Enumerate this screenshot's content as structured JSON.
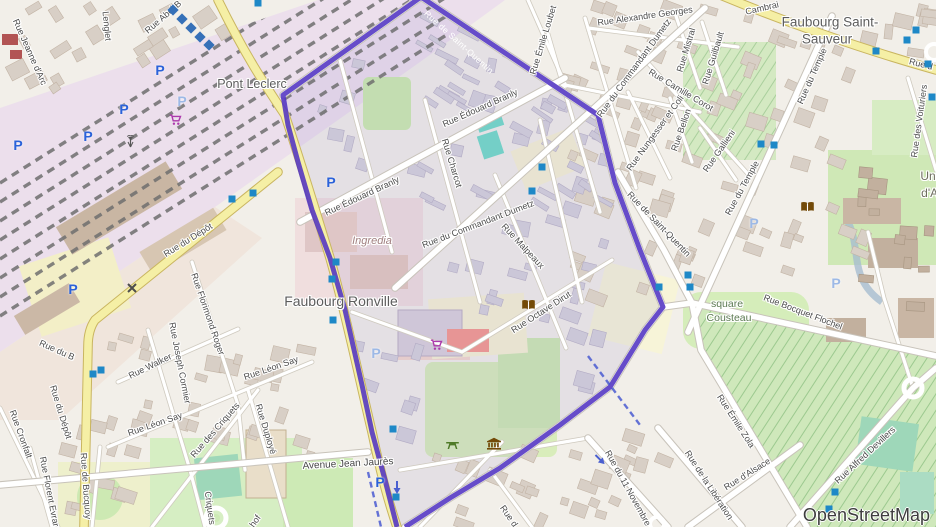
{
  "attribution": {
    "text": "OpenStreetMap"
  },
  "colors": {
    "boundary_purple": "#5133c2",
    "road_yellow": "#f5efa5",
    "base": "#f2efe9",
    "building_gray": "#d8cfc6",
    "building_inner": "#cbc7d8",
    "park_green": "#cdebb0",
    "pitch_teal": "#9ed7b9",
    "marker_blue": "#1e88c7",
    "parking_blue": "#2b62d9",
    "rail_area": "#ecdfec"
  },
  "place_labels": [
    {
      "text": "Pont Leclerc",
      "x": 252,
      "y": 84,
      "cls": "town",
      "size": 12.5
    },
    {
      "text": "Faubourg Saint-",
      "x": 830,
      "y": 22,
      "cls": "town",
      "size": 13.5
    },
    {
      "text": "Sauveur",
      "x": 827,
      "y": 39,
      "cls": "town",
      "size": 13.5
    },
    {
      "text": "Faubourg  Ronville",
      "x": 341,
      "y": 301,
      "cls": "town",
      "size": 14
    },
    {
      "text": "Ingredia",
      "x": 372,
      "y": 241,
      "cls": "ind",
      "size": 11
    },
    {
      "text": "square",
      "x": 727,
      "y": 304,
      "cls": "park",
      "size": 10.5
    },
    {
      "text": "Cousteau",
      "x": 729,
      "y": 318,
      "cls": "park",
      "size": 10.5
    },
    {
      "text": "Université",
      "x": 947,
      "y": 176,
      "cls": "univ",
      "size": 12
    },
    {
      "text": "d'Artois",
      "x": 941,
      "y": 193,
      "cls": "univ",
      "size": 12
    }
  ],
  "street_labels": [
    {
      "text": "Rue Jeanne d'Arc",
      "x": 30,
      "y": 52,
      "rot": 66
    },
    {
      "text": "Lenglet",
      "x": 107,
      "y": 26,
      "rot": 84
    },
    {
      "text": "Rue Abel B",
      "x": 163,
      "y": 17,
      "rot": -41
    },
    {
      "text": "Rue Alexandre Georges",
      "x": 645,
      "y": 16,
      "rot": -8
    },
    {
      "text": "Cambrai",
      "x": 762,
      "y": 8,
      "rot": -13
    },
    {
      "text": "Rue d",
      "x": 921,
      "y": 64,
      "rot": 14
    },
    {
      "text": "Rue Émile Loubet",
      "x": 543,
      "y": 40,
      "rot": -73
    },
    {
      "text": "Rue Mistral",
      "x": 686,
      "y": 50,
      "rot": -73
    },
    {
      "text": "Rue Guilbault",
      "x": 713,
      "y": 58,
      "rot": -73
    },
    {
      "text": "Rue du Commandant Dumetz",
      "x": 634,
      "y": 68,
      "rot": -54
    },
    {
      "text": "Rue Camille Corot",
      "x": 681,
      "y": 90,
      "rot": 31
    },
    {
      "text": "Rue du Temple",
      "x": 812,
      "y": 76,
      "rot": -66
    },
    {
      "text": "Rue Bellon",
      "x": 681,
      "y": 130,
      "rot": -71
    },
    {
      "text": "Rue Nungesser et Coli",
      "x": 655,
      "y": 133,
      "rot": -54
    },
    {
      "text": "Rue Gallieni",
      "x": 719,
      "y": 151,
      "rot": -55
    },
    {
      "text": "Rue des Voituriers",
      "x": 919,
      "y": 121,
      "rot": -82
    },
    {
      "text": "Rue du Temple",
      "x": 742,
      "y": 188,
      "rot": -61
    },
    {
      "text": "Rue de Saint-Quentin",
      "x": 459,
      "y": 42,
      "rot": 42,
      "cls": "stw"
    },
    {
      "text": "Rue de Saint-Quentin",
      "x": 659,
      "y": 224,
      "rot": 46
    },
    {
      "text": "Rue Édouard Branly",
      "x": 480,
      "y": 108,
      "rot": -24
    },
    {
      "text": "Rue Charcot",
      "x": 452,
      "y": 163,
      "rot": 73
    },
    {
      "text": "Rue Édouard Branly",
      "x": 362,
      "y": 196,
      "rot": -25
    },
    {
      "text": "Rue du Commandant Dumetz",
      "x": 478,
      "y": 224,
      "rot": -21
    },
    {
      "text": "Rue Malpeaux",
      "x": 523,
      "y": 246,
      "rot": 47
    },
    {
      "text": "Rue Octave Dirut",
      "x": 541,
      "y": 312,
      "rot": -33
    },
    {
      "text": "Rue Bocquet Flochel",
      "x": 803,
      "y": 312,
      "rot": 21
    },
    {
      "text": "Rue du Dépôt",
      "x": 188,
      "y": 240,
      "rot": -32
    },
    {
      "text": "Rue du B",
      "x": 57,
      "y": 350,
      "rot": 24
    },
    {
      "text": "Rue du Dépôt",
      "x": 61,
      "y": 412,
      "rot": 73
    },
    {
      "text": "Rue de Bucquoy",
      "x": 86,
      "y": 486,
      "rot": 86
    },
    {
      "text": "Rue Cronfalt",
      "x": 21,
      "y": 434,
      "rot": 70
    },
    {
      "text": "Rue Florent Evrard",
      "x": 50,
      "y": 494,
      "rot": 79
    },
    {
      "text": "Rue Walker",
      "x": 150,
      "y": 366,
      "rot": -26
    },
    {
      "text": "Rue Joseph Cormier",
      "x": 180,
      "y": 363,
      "rot": 79
    },
    {
      "text": "Rue Florimond Roger",
      "x": 208,
      "y": 314,
      "rot": 71
    },
    {
      "text": "Rue Léon Say",
      "x": 271,
      "y": 368,
      "rot": -19
    },
    {
      "text": "Rue Léon Say",
      "x": 155,
      "y": 424,
      "rot": -19
    },
    {
      "text": "Rue des Criquets",
      "x": 215,
      "y": 430,
      "rot": -49
    },
    {
      "text": "Criquets",
      "x": 210,
      "y": 508,
      "rot": 82
    },
    {
      "text": "Rue Duployé",
      "x": 266,
      "y": 429,
      "rot": 73
    },
    {
      "text": "hof",
      "x": 255,
      "y": 521,
      "rot": -55
    },
    {
      "text": "Avenue Jean Jaurès",
      "x": 348,
      "y": 464,
      "rot": -3,
      "cls": "stb"
    },
    {
      "text": "Rue d",
      "x": 509,
      "y": 516,
      "rot": 55
    },
    {
      "text": "Rue du 11 Novembre",
      "x": 628,
      "y": 488,
      "rot": 61
    },
    {
      "text": "Rue de la Libération",
      "x": 709,
      "y": 485,
      "rot": 57
    },
    {
      "text": "Rue d'Alsace",
      "x": 747,
      "y": 474,
      "rot": -32
    },
    {
      "text": "Rue Émile Zola",
      "x": 736,
      "y": 421,
      "rot": 57
    },
    {
      "text": "Rue Alfred Devillers",
      "x": 865,
      "y": 455,
      "rot": -43
    }
  ],
  "parking_icons": [
    {
      "x": 18,
      "y": 146
    },
    {
      "x": 88,
      "y": 137
    },
    {
      "x": 124,
      "y": 110
    },
    {
      "x": 160,
      "y": 71
    },
    {
      "x": 182,
      "y": 102,
      "light": true
    },
    {
      "x": 73,
      "y": 290
    },
    {
      "x": 331,
      "y": 183
    },
    {
      "x": 376,
      "y": 354,
      "light": true
    },
    {
      "x": 380,
      "y": 483
    },
    {
      "x": 754,
      "y": 224,
      "light": true
    },
    {
      "x": 836,
      "y": 284,
      "light": true
    }
  ],
  "transit_squares": [
    [
      258,
      3
    ],
    [
      542,
      167
    ],
    [
      532,
      191
    ],
    [
      336,
      262
    ],
    [
      332,
      279
    ],
    [
      333,
      320
    ],
    [
      232,
      199
    ],
    [
      253,
      193
    ],
    [
      93,
      374
    ],
    [
      101,
      370
    ],
    [
      393,
      429
    ],
    [
      396,
      497
    ],
    [
      688,
      275
    ],
    [
      690,
      287
    ],
    [
      659,
      287
    ],
    [
      761,
      144
    ],
    [
      774,
      145
    ],
    [
      907,
      40
    ],
    [
      916,
      30
    ],
    [
      876,
      51
    ],
    [
      928,
      64
    ],
    [
      835,
      492
    ],
    [
      829,
      509
    ],
    [
      932,
      97
    ]
  ],
  "transit_diamonds": [
    [
      173,
      10
    ],
    [
      182,
      19
    ],
    [
      191,
      28
    ],
    [
      200,
      37
    ],
    [
      209,
      45
    ]
  ],
  "poi_icons": [
    {
      "type": "library-icon",
      "x": 521,
      "y": 299
    },
    {
      "type": "library-icon",
      "x": 800,
      "y": 201
    },
    {
      "type": "museum-icon",
      "x": 486,
      "y": 437
    },
    {
      "type": "picnic-icon",
      "x": 445,
      "y": 439
    },
    {
      "type": "supermarket-icon",
      "x": 430,
      "y": 339
    },
    {
      "type": "shop-icon",
      "x": 169,
      "y": 114
    },
    {
      "type": "mast-icon",
      "x": 125,
      "y": 135
    },
    {
      "type": "level-crossing-icon",
      "x": 126,
      "y": 282
    },
    {
      "type": "oneway-down-icon",
      "x": 393,
      "y": 481
    },
    {
      "type": "oneway-se-icon",
      "x": 596,
      "y": 453
    }
  ]
}
